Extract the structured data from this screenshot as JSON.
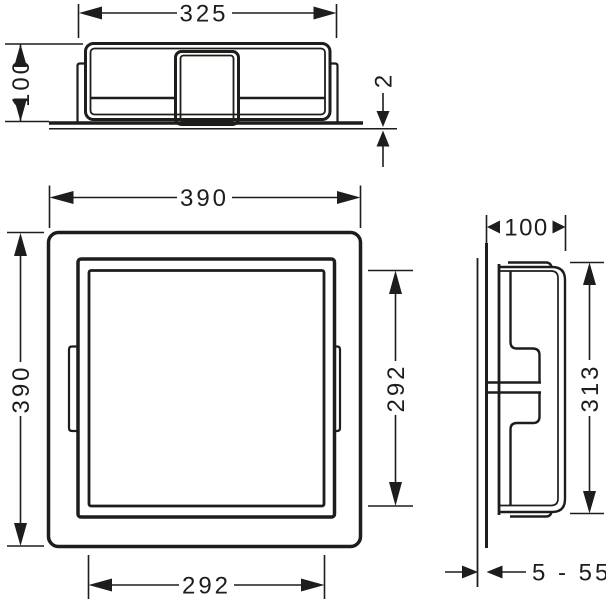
{
  "drawing": {
    "kind": "installation-dimension-drawing",
    "line_color": "#1d1d1b",
    "background_color": "#ffffff"
  },
  "top_view": {
    "width_label": "325",
    "height_label": "100",
    "flange_thickness_label": "2"
  },
  "front_view": {
    "outer_width_label": "390",
    "outer_height_label": "390",
    "inner_height_label": "292",
    "inner_width_label": "292"
  },
  "side_view": {
    "depth_label": "100",
    "inner_height_label": "313",
    "tile_range_label": "5 - 55"
  }
}
